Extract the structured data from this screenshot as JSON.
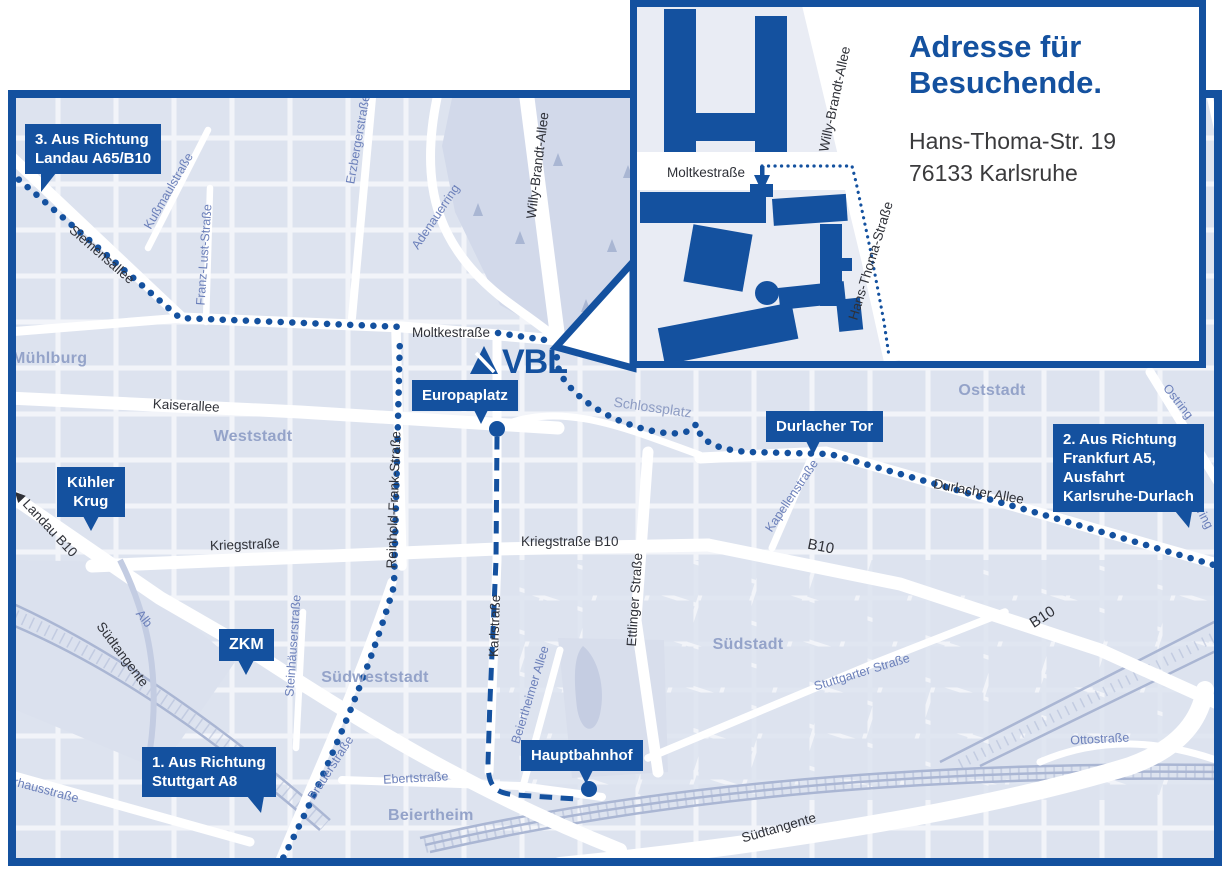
{
  "logo": {
    "text": "VBL"
  },
  "inset": {
    "title_line1": "Adresse für",
    "title_line2": "Besuchende.",
    "address_line1": "Hans-Thoma-Str. 19",
    "address_line2": "76133 Karlsruhe",
    "streets": {
      "moltkestrasse": "Moltkestraße",
      "willy_brandt_allee": "Willy-Brandt-Allee",
      "hans_thoma_strasse": "Hans-Thoma-Straße"
    }
  },
  "callouts": {
    "landau": {
      "line1": "3. Aus Richtung",
      "line2": "Landau A65/B10"
    },
    "frankfurt": {
      "line1": "2. Aus Richtung",
      "line2": "Frankfurt A5,",
      "line3": "Ausfahrt",
      "line4": "Karlsruhe-Durlach"
    },
    "stuttgart": {
      "line1": "1. Aus Richtung",
      "line2": "Stuttgart A8"
    },
    "kuehler_krug": {
      "line1": "Kühler",
      "line2": "Krug"
    },
    "zkm": {
      "line1": "ZKM"
    },
    "europaplatz": {
      "line1": "Europaplatz"
    },
    "durlacher_tor": {
      "line1": "Durlacher Tor"
    },
    "hauptbahnhof": {
      "line1": "Hauptbahnhof"
    }
  },
  "districts": {
    "muehlburg": "Mühlburg",
    "weststadt": "Weststadt",
    "oststadt": "Oststadt",
    "suedstadt": "Südstadt",
    "suedweststadt": "Südweststadt",
    "beiertheim": "Beiertheim"
  },
  "streets": {
    "siemensallee": "Siemensallee",
    "kussmaulstrasse": "Kußmaulstraße",
    "franz_lust_strasse": "Franz-Lust-Straße",
    "erzbergerstrasse": "Erzbergerstraße",
    "adenauerring": "Adenauerring",
    "willy_brandt_allee": "Willy-Brandt-Allee",
    "moltkestrasse": "Moltkestraße",
    "kaiserallee": "Kaiserallee",
    "reinhold_frank_strasse": "Reinhold-Frank-Straße",
    "kriegstrasse": "Kriegstraße",
    "kriegstrasse_b10": "Kriegstraße B10",
    "karlstrasse": "Karlstraße",
    "ettlinger_strasse": "Ettlinger Straße",
    "schlossplatz": "Schlossplatz",
    "durlacher_allee": "Durlacher Allee",
    "kapellenstrasse": "Kapellenstraße",
    "ostring": "Ostring",
    "b10": "B10",
    "landau_b10": "◀ Landau B10",
    "suedtangente": "Südtangente",
    "alb": "Alb",
    "steinhaeuserstrasse": "Steinhäuserstraße",
    "brauerstrasse": "Brauerstraße",
    "ebertstrasse": "Ebertstraße",
    "pulverhausstrasse": "Pulverhausstraße",
    "beiertheimer_allee": "Beiertheimer Allee",
    "stuttgarter_strasse": "Stuttgarter Straße",
    "ottostrasse": "Ottostraße"
  },
  "colors": {
    "brand_blue": "#14519F",
    "map_background": "#F2F4F9",
    "block_fill": "#DDE3EF",
    "park_fill": "#D2D9EA",
    "district_label": "#94A3C9",
    "street_label_dark": "#2F3138",
    "street_label_blue": "#6C80BA",
    "railway": "#AAB6D3",
    "address_text": "#3A3A3C",
    "white_street": "#FFFFFF"
  }
}
